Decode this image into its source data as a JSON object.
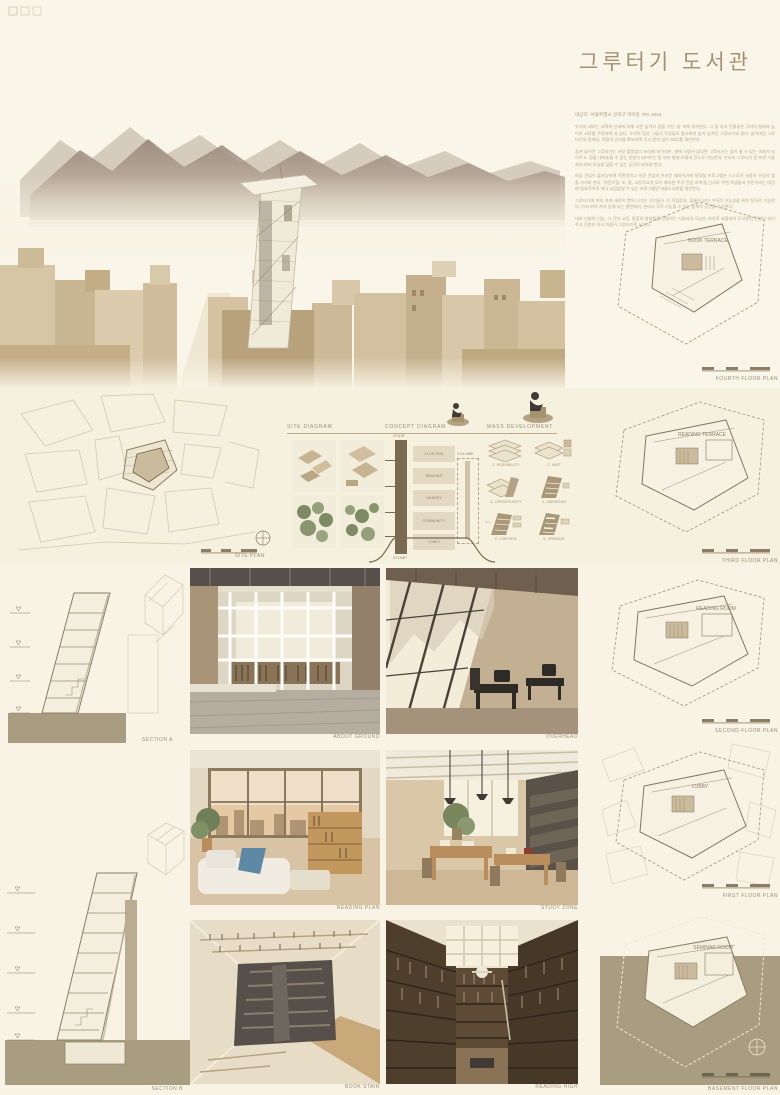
{
  "title": "그루터기 도서관",
  "intro": {
    "address": "대상지: 서울특별시 강북구 미아동 791-1504",
    "paragraphs": [
      "우리의 대지는 서쪽의 산세에 의해 다른 높이의 땅을 가진 '섬' 속에 위치한다. 그 섬 속의 건물들은 각자의 형태와 높이로 서로를 주장하며 서 있다. 우리의 땅은 그들의 주장들로 둘러싸여 숨겨 남겨진 그루터기와 같다. 숨어버린 그루터기의 땅에서, 작음의 인식을 확보하며 무시 받지 않는 SOC를 제안한다.",
      "숨겨 남겨진 그루터기는 자칫 볼품없고 초라해 보이지만, 곁에 사람이 있다면 그루터기는 앉아 쉴 수 있는 의자가 되어주고, 짐을 내려놓을 수 있는 받침이 되어주는 등 여러 형태 모델의 장소로 기능한다. 우리의 그루터기 땅 또한 사용자의 여러 모습을 담을 수 있는 공간이 되어야 한다.",
      "마당 진입이 불가능하며 직관적이고 쉬운 진입이 어려운 대지이기에 설정될 프로그램은 스스로가 사용자 유입의 힘을 가져야 한다. '어린이집, 초, 중, 고등학교가 모두 배치된 주거 전용 지역'을 단서로 주변 학생들과 주민이라는 대상에 필요적이며 보다 교집합일 수 있는 프로그램인 마을도서관을 제안한다.",
      "그루터기에 뿌리 하여 새로이 뻗어 나가는 가지들은 각 독립함과, 볼륨이 되어 수직적 가능성을 위한 장치로 기능한다. 가지 위의 켜가 입체 되는 평면에서, 분리나 각각 기능할 수 있는 입체적 공간을 구성한다.",
      "내부 다층의 기능, 그 간의 교류, 중첩의 형태들을 경험하는 사용자의 모습은 외부로 표출되어 도서관의 간판이 되어주고 간판은 다시 마을의 그루터기로 남는다."
    ]
  },
  "site_plan": {
    "label": "SITE PLAN"
  },
  "diagram_headers": {
    "site": "SITE DIAGRAM",
    "concept": "CONCEPT DIAGRAM",
    "mass": "MASS DEVELOPMENT"
  },
  "concept_diagram": {
    "top_label": "STAIR",
    "bottom_label": "STUMP",
    "volume_label": "VOLUME",
    "levels": [
      "STUDYING",
      "READING",
      "LIBRARY",
      "COMMUNITY",
      "LOBBY"
    ]
  },
  "mass_steps": [
    "1. POSSIBILITY",
    "2. UNIT",
    "3. OPPORTUNITY",
    "4. VARIATION",
    "5. CONTROL",
    "6. OPENING"
  ],
  "floor_plans": [
    {
      "label": "FOURTH FLOOR PLAN",
      "room": "BOOK TERRACE"
    },
    {
      "label": "THIRD FLOOR PLAN",
      "room": "READING TERRACE"
    },
    {
      "label": "SECOND FLOOR PLAN",
      "room": "READING ROOM"
    },
    {
      "label": "FIRST FLOOR PLAN",
      "room": "LOBBY"
    },
    {
      "label": "BASEMENT FLOOR PLAN",
      "room": "SEMINAR ROOM"
    }
  ],
  "sections": [
    {
      "label": "SECTION A"
    },
    {
      "label": "SECTION B"
    }
  ],
  "renders": [
    {
      "caption": "ABOUT GROUND"
    },
    {
      "caption": "OVERHEAD"
    },
    {
      "caption": "READING PLAN"
    },
    {
      "caption": "STUDY ZONE"
    },
    {
      "caption": "BOOK STAIR"
    },
    {
      "caption": "READING HIGH"
    }
  ],
  "colors": {
    "background": "#f8f3e5",
    "title": "#a29173",
    "olive_ground": "#a89d80",
    "line_brown": "#8b7d66",
    "trunk_brown": "#7a6a4f"
  }
}
